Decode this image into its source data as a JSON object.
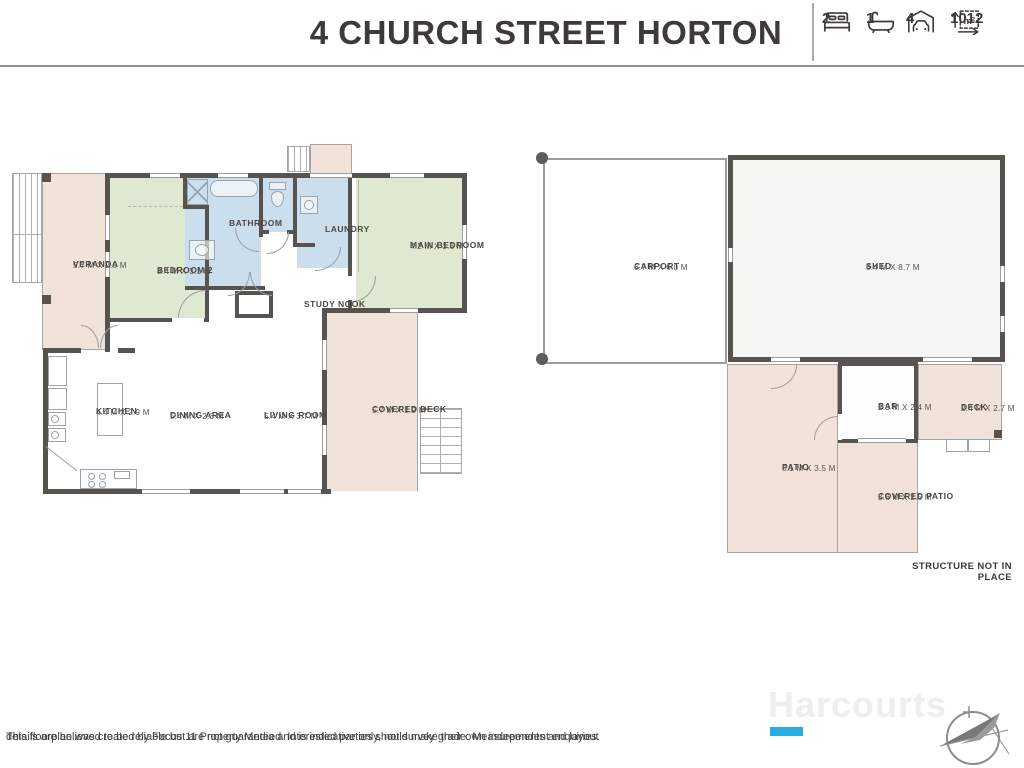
{
  "header": {
    "title": "4 CHURCH STREET HORTON",
    "stats": {
      "beds": {
        "icon": "bed-icon",
        "value": "2"
      },
      "baths": {
        "icon": "bath-icon",
        "value": "1"
      },
      "cars": {
        "icon": "car-icon",
        "value": "4"
      },
      "area": {
        "icon": "area-icon",
        "value": "1012",
        "unit": "m²"
      }
    }
  },
  "house": {
    "rooms": {
      "veranda": {
        "name": "VERANDA",
        "dims": "5.7 M X 2.0 M"
      },
      "bedroom2": {
        "name": "BEDROOM 2",
        "dims": "3.4 M X 3.1 M"
      },
      "bathroom": {
        "name": "BATHROOM",
        "dims": ""
      },
      "laundry": {
        "name": "LAUNDRY",
        "dims": ""
      },
      "main_bedroom": {
        "name": "MAIN BEDROOM",
        "dims": "4.2 M X 3.6 M"
      },
      "study_nook": {
        "name": "STUDY NOOK",
        "dims": ""
      },
      "kitchen": {
        "name": "KITCHEN",
        "dims": "4.4 M X 2.9 M"
      },
      "dining": {
        "name": "DINING AREA",
        "dims": "5.4 M X 2.3 M"
      },
      "living": {
        "name": "LIVING ROOM",
        "dims": "5.4 M X 3.7 M"
      },
      "covered_deck": {
        "name": "COVERED DECK",
        "dims": "5.7 M X 2.9 M"
      }
    }
  },
  "outbuildings": {
    "rooms": {
      "carport": {
        "name": "CARPORT",
        "dims": "6.7 M X 6.0 M"
      },
      "shed": {
        "name": "SHED",
        "dims": "6.4 M X 8.7 M"
      },
      "bar": {
        "name": "BAR",
        "dims": "2.3 M X 2.4 M"
      },
      "deck": {
        "name": "DECK",
        "dims": "2.4 M X 2.7 M"
      },
      "patio": {
        "name": "PATIO",
        "dims": "6.1 M X 3.5 M"
      },
      "covered_patio": {
        "name": "COVERED PATIO",
        "dims": "3.6 M X 2.5 M"
      }
    },
    "note": "STRUCTURE NOT IN PLACE"
  },
  "footer": {
    "disclaimer_line1": "This floorplan was created by Focus 11 Property Media and is indicative only, not survey grade. Measurements and layout",
    "disclaimer_line2": "details are believed to be reliable but are not guaranteed. Interested parties should make their own independent enquiries.",
    "brand": "Harcourts"
  },
  "colors": {
    "wall": "#57534f",
    "room_green": "#dfe9d2",
    "room_blue": "#cbdeee",
    "outdoor_beige": "#f1e3d9",
    "shed_fill": "#f5f5f4",
    "accent_cyan": "#29abe2",
    "title_text": "#3e3a37",
    "label_text": "#4a4643"
  }
}
